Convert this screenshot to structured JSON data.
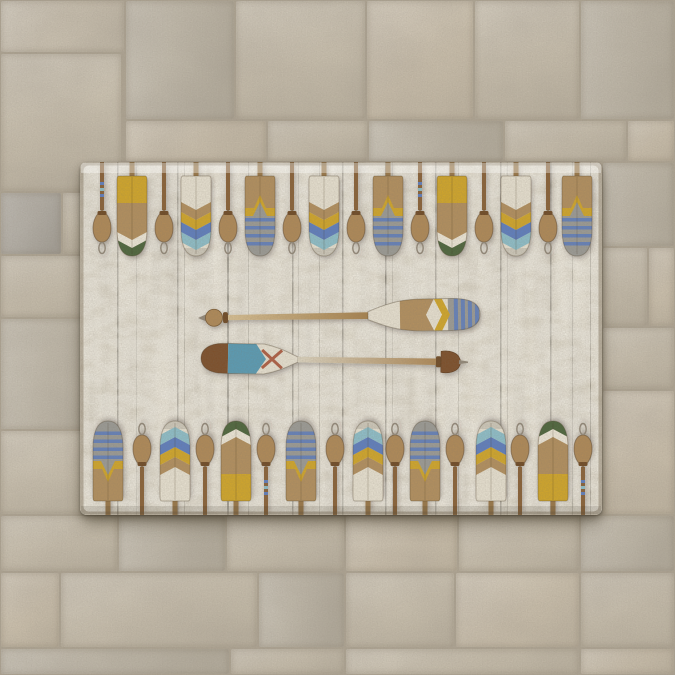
{
  "scene": {
    "description": "Rectangular area rug printed with rows of vintage painted boat oars, paddles and rope cleats on distressed whitewashed wood planks, two crossed oars in the center, lying on a beige stone paver tile floor"
  },
  "palette": {
    "cream": "#e9e3d3",
    "creamDark": "#d8d1bd",
    "tan": "#b3905e",
    "tanDark": "#9a7848",
    "yellow": "#d2a72b",
    "green": "#4e663e",
    "blue": "#5f7fc0",
    "lightBlue": "#8fc0cb",
    "grayBlade": "#9c9c97",
    "teal": "#5a9cb5",
    "red": "#a84f35",
    "brownShaft": "#8a6238",
    "brownDark": "#6f4b26",
    "brownCap": "#7d4f2c",
    "pegTan": "#b08a58",
    "metal": "#93897a",
    "plankLine": "#3e3a30",
    "grout": "#b1a795",
    "tile0": "#d2c9b8",
    "tile1": "#cdc4b2",
    "tile2": "#c6bfb0",
    "tile3": "#d0c5b1",
    "tile4": "#b8b4ac"
  },
  "rug": {
    "plank_lines": [
      [
        37,
        1.5,
        0.5
      ],
      [
        56,
        1,
        0.2
      ],
      [
        97,
        1.5,
        0.45
      ],
      [
        104,
        1,
        0.28
      ],
      [
        147,
        2,
        0.55
      ],
      [
        168,
        1,
        0.32
      ],
      [
        212,
        1.5,
        0.5
      ],
      [
        218,
        1,
        0.22
      ],
      [
        239,
        1,
        0.28
      ],
      [
        262,
        1.5,
        0.48
      ],
      [
        305,
        1.5,
        0.52
      ],
      [
        312,
        1,
        0.22
      ],
      [
        355,
        1.5,
        0.45
      ],
      [
        378,
        1,
        0.28
      ],
      [
        420,
        1.5,
        0.5
      ],
      [
        427,
        1,
        0.22
      ],
      [
        470,
        1.5,
        0.45
      ],
      [
        492,
        1,
        0.28
      ],
      [
        510,
        1,
        0.38
      ]
    ],
    "top_row": [
      {
        "kind": "peg-striped",
        "x": 22
      },
      {
        "kind": "blade-a",
        "x": 52
      },
      {
        "kind": "peg",
        "x": 84
      },
      {
        "kind": "blade-d",
        "x": 116
      },
      {
        "kind": "peg",
        "x": 148
      },
      {
        "kind": "blade-c",
        "x": 180
      },
      {
        "kind": "peg",
        "x": 212
      },
      {
        "kind": "blade-d",
        "x": 244
      },
      {
        "kind": "peg",
        "x": 276
      },
      {
        "kind": "blade-c",
        "x": 308
      },
      {
        "kind": "peg-striped",
        "x": 340
      },
      {
        "kind": "blade-a",
        "x": 372
      },
      {
        "kind": "peg",
        "x": 404
      },
      {
        "kind": "blade-d",
        "x": 436
      },
      {
        "kind": "peg",
        "x": 468
      },
      {
        "kind": "blade-c",
        "x": 497
      }
    ],
    "bottom_row": [
      {
        "kind": "blade-c",
        "x": 28
      },
      {
        "kind": "peg",
        "x": 62
      },
      {
        "kind": "blade-d",
        "x": 95
      },
      {
        "kind": "peg",
        "x": 125
      },
      {
        "kind": "blade-a",
        "x": 156
      },
      {
        "kind": "peg-striped",
        "x": 186
      },
      {
        "kind": "blade-c",
        "x": 221
      },
      {
        "kind": "peg",
        "x": 255
      },
      {
        "kind": "blade-d",
        "x": 288
      },
      {
        "kind": "peg",
        "x": 315
      },
      {
        "kind": "blade-c",
        "x": 345
      },
      {
        "kind": "peg",
        "x": 375
      },
      {
        "kind": "blade-d",
        "x": 411
      },
      {
        "kind": "peg",
        "x": 440
      },
      {
        "kind": "blade-a",
        "x": 473
      },
      {
        "kind": "peg-striped",
        "x": 503
      }
    ],
    "center_oars": [
      {
        "name": "upper-oar",
        "handle": "left",
        "blade": "right",
        "blade_pattern": "cream, tan fishtail band, yellow chevron, gray tip with blue stripes"
      },
      {
        "name": "lower-oar",
        "handle": "right",
        "blade": "left",
        "blade_pattern": "brown cap, teal chevron band, cream with red X"
      }
    ]
  },
  "floor": {
    "tiles": [
      [
        0,
        0,
        125,
        53,
        0
      ],
      [
        0,
        53,
        122,
        139,
        1
      ],
      [
        125,
        0,
        110,
        120,
        2
      ],
      [
        235,
        0,
        131,
        120,
        1
      ],
      [
        366,
        0,
        108,
        120,
        3
      ],
      [
        474,
        0,
        106,
        120,
        1
      ],
      [
        580,
        0,
        95,
        120,
        2
      ],
      [
        125,
        120,
        142,
        42,
        3
      ],
      [
        267,
        120,
        101,
        42,
        1
      ],
      [
        368,
        120,
        136,
        42,
        2
      ],
      [
        504,
        120,
        123,
        42,
        1
      ],
      [
        627,
        120,
        48,
        42,
        3
      ],
      [
        0,
        192,
        62,
        63,
        4
      ],
      [
        62,
        192,
        60,
        63,
        1
      ],
      [
        0,
        255,
        122,
        63,
        1
      ],
      [
        0,
        318,
        122,
        112,
        2
      ],
      [
        0,
        430,
        122,
        85,
        1
      ],
      [
        602,
        162,
        73,
        85,
        2
      ],
      [
        602,
        247,
        46,
        80,
        1
      ],
      [
        648,
        247,
        27,
        80,
        3
      ],
      [
        602,
        327,
        73,
        63,
        1
      ],
      [
        602,
        390,
        73,
        125,
        3
      ],
      [
        0,
        515,
        118,
        57,
        1
      ],
      [
        118,
        515,
        108,
        57,
        2
      ],
      [
        226,
        515,
        119,
        57,
        1
      ],
      [
        345,
        515,
        113,
        57,
        3
      ],
      [
        458,
        515,
        122,
        57,
        1
      ],
      [
        580,
        515,
        95,
        57,
        2
      ],
      [
        0,
        572,
        60,
        76,
        3
      ],
      [
        60,
        572,
        198,
        76,
        1
      ],
      [
        258,
        572,
        87,
        76,
        2
      ],
      [
        345,
        572,
        110,
        76,
        1
      ],
      [
        455,
        572,
        125,
        76,
        3
      ],
      [
        580,
        572,
        95,
        76,
        1
      ],
      [
        0,
        648,
        230,
        27,
        2
      ],
      [
        230,
        648,
        115,
        27,
        1
      ],
      [
        345,
        648,
        235,
        27,
        1
      ],
      [
        580,
        648,
        95,
        27,
        3
      ]
    ]
  }
}
